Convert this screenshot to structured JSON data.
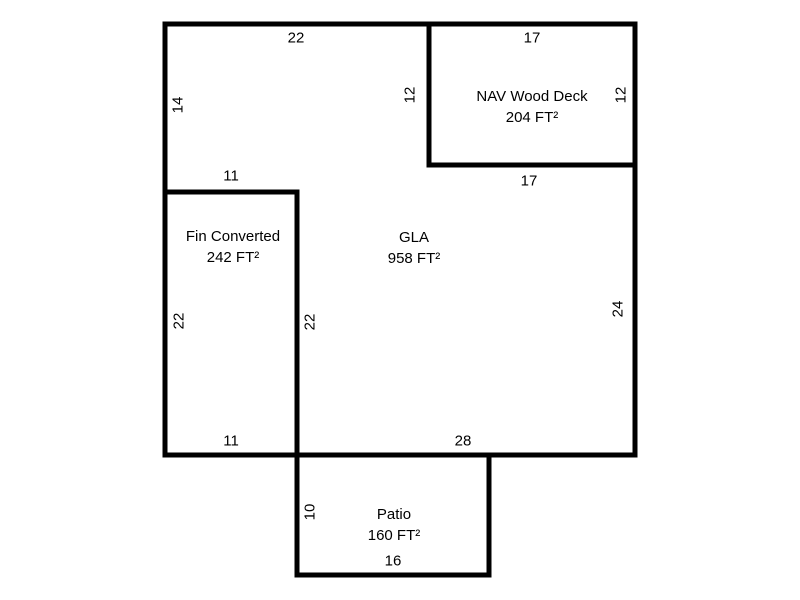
{
  "colors": {
    "background": "#ffffff",
    "line": "#000000",
    "text": "#000000"
  },
  "areas": {
    "gla": {
      "name": "GLA",
      "area": "958 FT²"
    },
    "nav_wood_deck": {
      "name": "NAV Wood Deck",
      "area": "204 FT²"
    },
    "fin_converted": {
      "name": "Fin Converted",
      "area": "242 FT²"
    },
    "patio": {
      "name": "Patio",
      "area": "160 FT²"
    }
  },
  "dimensions": {
    "gla_top": "22",
    "deck_top": "17",
    "gla_left_upper": "14",
    "deck_left": "12",
    "deck_right": "12",
    "fin_top": "11",
    "deck_bottom": "17",
    "fin_left": "22",
    "fin_right": "22",
    "gla_right": "24",
    "gla_bottom_left": "11",
    "gla_bottom_right": "28",
    "patio_left": "10",
    "patio_bottom": "16"
  }
}
